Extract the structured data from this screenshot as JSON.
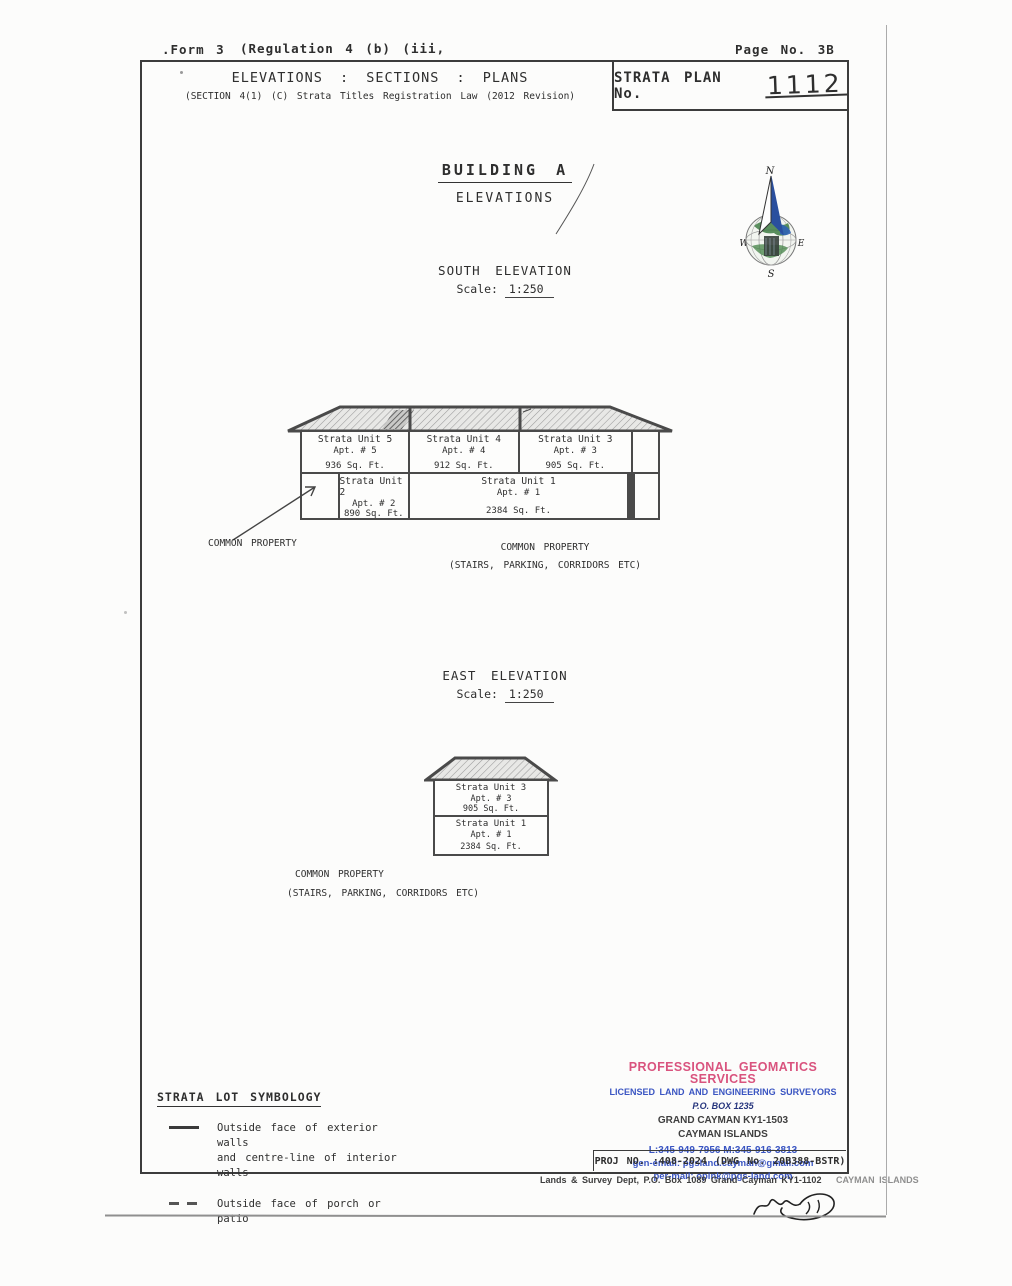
{
  "page": {
    "form_label": ".Form 3",
    "regulation_label": "(Regulation 4 (b) (iii,",
    "page_no": "Page No. 3B"
  },
  "header": {
    "title": "ELEVATIONS : SECTIONS : PLANS",
    "subtitle": "(SECTION 4(1) (C) Strata Titles Registration Law (2012 Revision)",
    "strata_plan_label": "STRATA PLAN No.",
    "strata_plan_number": "1112"
  },
  "drawing": {
    "building_title": "BUILDING A",
    "building_subtitle": "ELEVATIONS",
    "compass": {
      "n": "N",
      "s": "S",
      "e": "E",
      "w": "W"
    },
    "south": {
      "title": "SOUTH ELEVATION",
      "scale_label": "Scale:",
      "scale_value": "1:250",
      "upper_units": [
        {
          "name": "Strata Unit 5",
          "apt": "Apt. # 5",
          "area": "936 Sq. Ft."
        },
        {
          "name": "Strata Unit 4",
          "apt": "Apt. # 4",
          "area": "912 Sq. Ft."
        },
        {
          "name": "Strata Unit 3",
          "apt": "Apt. # 3",
          "area": "905 Sq. Ft."
        }
      ],
      "lower_units": [
        {
          "name": "Strata Unit 2",
          "apt": "Apt. # 2",
          "area": "890 Sq. Ft."
        },
        {
          "name": "Strata Unit 1",
          "apt": "Apt. # 1",
          "area": "2384 Sq. Ft."
        }
      ],
      "common_property_left": "COMMON PROPERTY",
      "common_property_center": "COMMON PROPERTY",
      "common_property_sub": "(STAIRS, PARKING, CORRIDORS ETC)"
    },
    "east": {
      "title": "EAST ELEVATION",
      "scale_label": "Scale:",
      "scale_value": "1:250",
      "units": [
        {
          "name": "Strata Unit 3",
          "apt": "Apt. # 3",
          "area": "905 Sq. Ft."
        },
        {
          "name": "Strata Unit 1",
          "apt": "Apt. # 1",
          "area": "2384 Sq. Ft."
        }
      ],
      "common_property": "COMMON PROPERTY",
      "common_property_sub": "(STAIRS, PARKING, CORRIDORS ETC)"
    }
  },
  "legend": {
    "title": "STRATA LOT SYMBOLOGY",
    "items": [
      {
        "symbol": "solid-line",
        "label_line1": "Outside face of exterior walls",
        "label_line2": "and centre-line of interior walls"
      },
      {
        "symbol": "dashed-line",
        "label_line1": "Outside face of porch or patio",
        "label_line2": ""
      }
    ]
  },
  "footer": {
    "company": "PROFESSIONAL GEOMATICS SERVICES",
    "tagline": "LICENSED LAND AND ENGINEERING SURVEYORS",
    "po_box": "P.O. BOX 1235",
    "city": "GRAND CAYMAN KY1-1503",
    "country": "CAYMAN ISLANDS",
    "phones": "L:345-949-7956  M:345-916-3813",
    "gen_email": "gen-email: pgsland.cayman@gmail.com",
    "per_email": "per-mail: opink@pgs-land.com",
    "proj_no": "PROJ NO. :408-2024  (DWG No. 20B388-BSTR)",
    "colors": {
      "pink": "#d9537e",
      "blue": "#3a55c2",
      "navy": "#26357d"
    }
  },
  "bottom": {
    "lands_survey": "Lands & Survey Dept, P.O. Box 1089 Grand Cayman  KY1-1102",
    "lands_survey_country": "CAYMAN ISLANDS"
  }
}
